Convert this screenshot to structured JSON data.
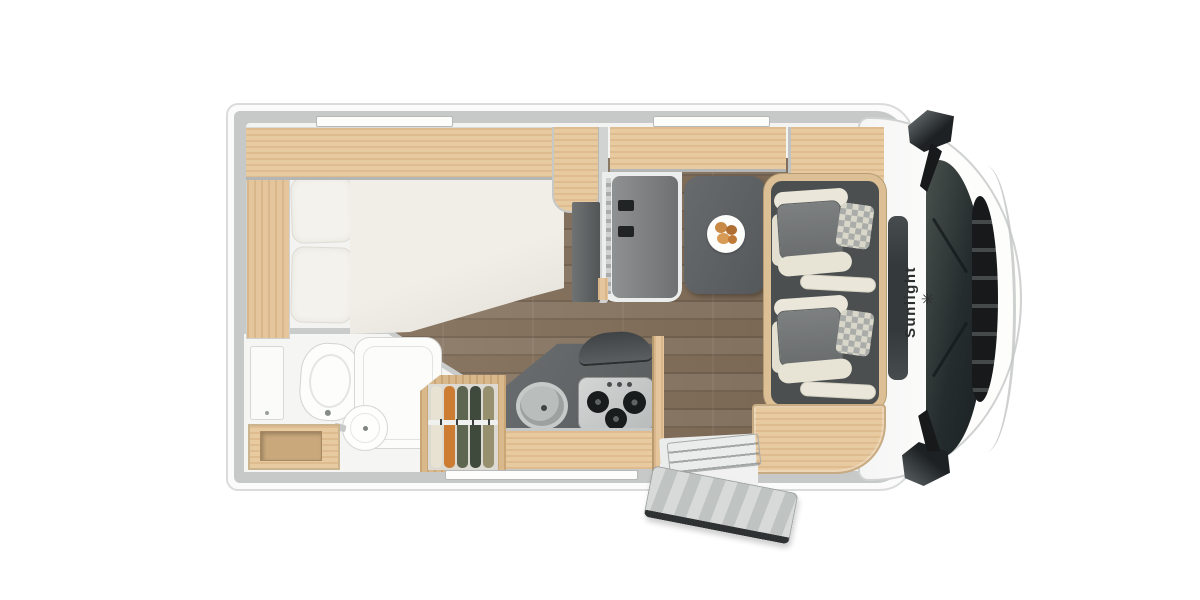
{
  "brand": {
    "label": "Sunlight",
    "logo_glyph": "✳"
  },
  "palette": {
    "wall_gray": "#c6c9c8",
    "wood_light": "#e8caa1",
    "wood_frame": "#dcbf94",
    "interior_white": "#f3f3f1",
    "floor_brown": "#84705b",
    "counter_dark": "#5f6364",
    "table_gray": "#5c6061",
    "seat_cream": "#e9e6d9",
    "seat_gray": "#75787a",
    "windshield_dark": "#232a2b",
    "mirror_black": "#202324"
  },
  "wardrobe": {
    "clothes_colors": [
      "#e8e2d2",
      "#cc7c33",
      "#5d6650",
      "#3f4a3c",
      "#97906f"
    ]
  }
}
